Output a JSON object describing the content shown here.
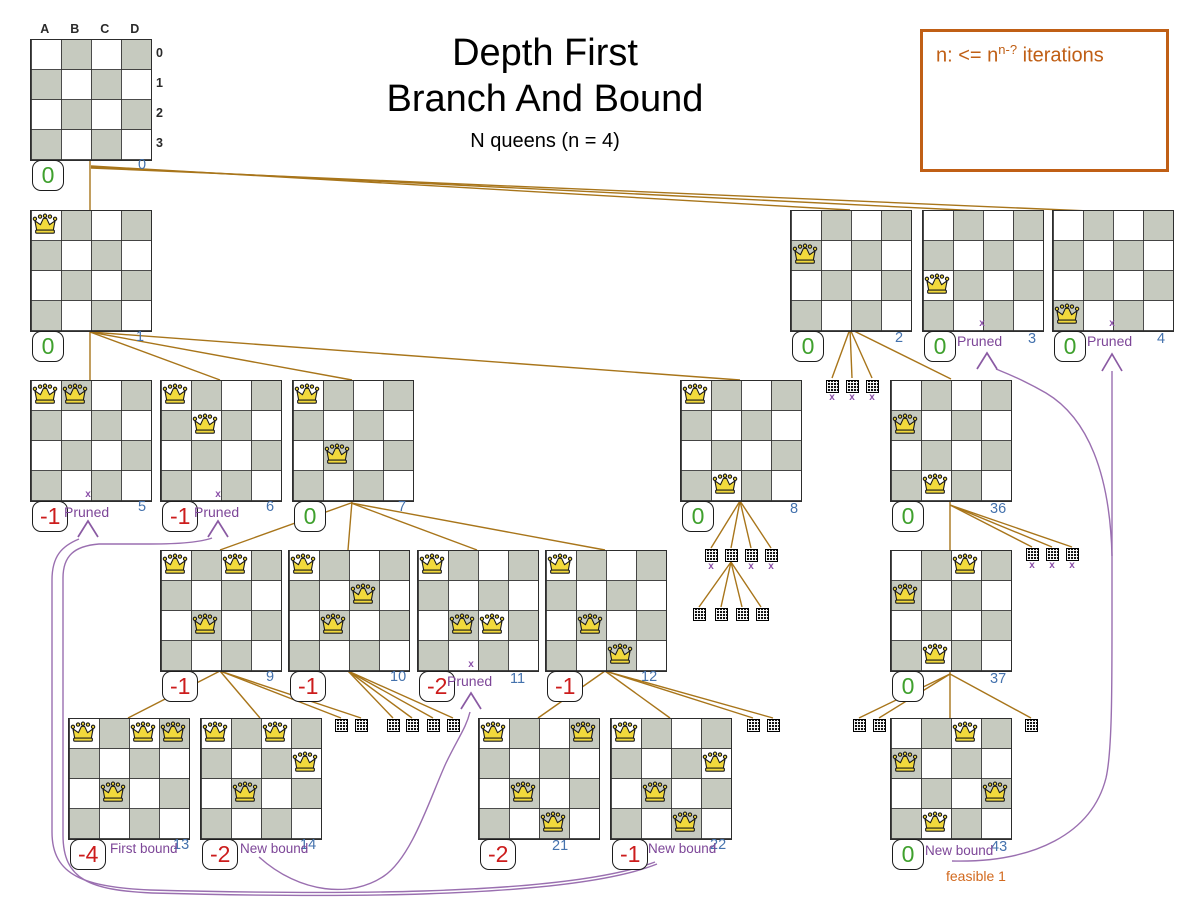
{
  "title": {
    "line1": "Depth First",
    "line2": "Branch And Bound",
    "subtitle": "N queens (n = 4)"
  },
  "legend": {
    "prefix": "n: <= n",
    "sup": "n-?",
    "suffix": " iterations"
  },
  "axis": {
    "cols": [
      "A",
      "B",
      "C",
      "D"
    ],
    "rows": [
      "0",
      "1",
      "2",
      "3"
    ]
  },
  "labels": {
    "pruned": "Pruned",
    "first_bound": "First bound",
    "new_bound": "New bound",
    "feasible": "feasible 1"
  },
  "colors": {
    "tree_line": "#a8751a",
    "prune_curve": "#9a6fb0",
    "prune_arrow": "#8a5aa3",
    "score_good": "#3fa02d",
    "score_bad": "#cc1c1c",
    "node_number": "#4472ad",
    "pruned_text": "#7d4698",
    "feasible_text": "#d2691e",
    "legend_orange": "#c05f15",
    "board_gray": "#c6cabf",
    "queen_gold": "#f2d93c"
  },
  "boards": [
    {
      "id": "0",
      "x": 30,
      "y": 39,
      "queens": [],
      "score": "0",
      "score_type": "good",
      "num": "0",
      "num_x": 138,
      "num_y": 157,
      "axis": true
    },
    {
      "id": "1",
      "x": 30,
      "y": 210,
      "queens": [
        [
          0,
          0
        ]
      ],
      "score": "0",
      "score_type": "good",
      "num": "1",
      "num_x": 136,
      "num_y": 329
    },
    {
      "id": "2",
      "x": 790,
      "y": 210,
      "queens": [
        [
          0,
          1
        ]
      ],
      "score": "0",
      "score_type": "good",
      "num": "2",
      "num_x": 895,
      "num_y": 330
    },
    {
      "id": "3",
      "x": 922,
      "y": 210,
      "queens": [
        [
          0,
          2
        ]
      ],
      "score": "0",
      "score_type": "good",
      "num": "3",
      "num_x": 1028,
      "num_y": 331,
      "pruned": {
        "x_x": 982,
        "x_y": 318,
        "t_x": 957,
        "t_y": 333
      }
    },
    {
      "id": "4",
      "x": 1052,
      "y": 210,
      "queens": [
        [
          0,
          3
        ]
      ],
      "score": "0",
      "score_type": "good",
      "num": "4",
      "num_x": 1157,
      "num_y": 331,
      "pruned": {
        "x_x": 1112,
        "x_y": 318,
        "t_x": 1087,
        "t_y": 333
      }
    },
    {
      "id": "5",
      "x": 30,
      "y": 380,
      "queens": [
        [
          0,
          0
        ],
        [
          1,
          0
        ]
      ],
      "score": "-1",
      "score_type": "bad",
      "num": "5",
      "num_x": 138,
      "num_y": 499,
      "pruned": {
        "x_x": 88,
        "x_y": 489,
        "t_x": 64,
        "t_y": 504
      }
    },
    {
      "id": "6",
      "x": 160,
      "y": 380,
      "queens": [
        [
          0,
          0
        ],
        [
          1,
          1
        ]
      ],
      "score": "-1",
      "score_type": "bad",
      "num": "6",
      "num_x": 266,
      "num_y": 499,
      "pruned": {
        "x_x": 218,
        "x_y": 489,
        "t_x": 194,
        "t_y": 504
      }
    },
    {
      "id": "7",
      "x": 292,
      "y": 380,
      "queens": [
        [
          0,
          0
        ],
        [
          1,
          2
        ]
      ],
      "score": "0",
      "score_type": "good",
      "num": "7",
      "num_x": 398,
      "num_y": 499
    },
    {
      "id": "8",
      "x": 680,
      "y": 380,
      "queens": [
        [
          0,
          0
        ],
        [
          1,
          3
        ]
      ],
      "score": "0",
      "score_type": "good",
      "num": "8",
      "num_x": 790,
      "num_y": 501
    },
    {
      "id": "36",
      "x": 890,
      "y": 380,
      "queens": [
        [
          0,
          1
        ],
        [
          1,
          3
        ]
      ],
      "score": "0",
      "score_type": "good",
      "num": "36",
      "num_x": 990,
      "num_y": 501
    },
    {
      "id": "9",
      "x": 160,
      "y": 550,
      "queens": [
        [
          0,
          0
        ],
        [
          2,
          0
        ],
        [
          1,
          2
        ]
      ],
      "score": "-1",
      "score_type": "bad",
      "num": "9",
      "num_x": 266,
      "num_y": 669
    },
    {
      "id": "10",
      "x": 288,
      "y": 550,
      "queens": [
        [
          0,
          0
        ],
        [
          2,
          1
        ],
        [
          1,
          2
        ]
      ],
      "score": "-1",
      "score_type": "bad",
      "num": "10",
      "num_x": 390,
      "num_y": 669
    },
    {
      "id": "11",
      "x": 417,
      "y": 550,
      "queens": [
        [
          0,
          0
        ],
        [
          1,
          2
        ],
        [
          2,
          2
        ]
      ],
      "score": "-2",
      "score_type": "bad",
      "num": "11",
      "num_x": 510,
      "num_y": 671,
      "pruned": {
        "x_x": 471,
        "x_y": 659,
        "t_x": 447,
        "t_y": 673
      }
    },
    {
      "id": "12",
      "x": 545,
      "y": 550,
      "queens": [
        [
          0,
          0
        ],
        [
          1,
          2
        ],
        [
          2,
          3
        ]
      ],
      "score": "-1",
      "score_type": "bad",
      "num": "12",
      "num_x": 641,
      "num_y": 669
    },
    {
      "id": "37",
      "x": 890,
      "y": 550,
      "queens": [
        [
          2,
          0
        ],
        [
          0,
          1
        ],
        [
          1,
          3
        ]
      ],
      "score": "0",
      "score_type": "good",
      "num": "37",
      "num_x": 990,
      "num_y": 671
    },
    {
      "id": "13",
      "x": 68,
      "y": 718,
      "queens": [
        [
          0,
          0
        ],
        [
          2,
          0
        ],
        [
          3,
          0
        ],
        [
          1,
          2
        ]
      ],
      "score": "-4",
      "score_type": "bad",
      "num": "13",
      "num_x": 173,
      "num_y": 837,
      "bound": {
        "text_key": "first_bound",
        "t_x": 110,
        "t_y": 841
      }
    },
    {
      "id": "14",
      "x": 200,
      "y": 718,
      "queens": [
        [
          0,
          0
        ],
        [
          2,
          0
        ],
        [
          3,
          1
        ],
        [
          1,
          2
        ]
      ],
      "score": "-2",
      "score_type": "bad",
      "num": "14",
      "num_x": 300,
      "num_y": 837,
      "bound": {
        "text_key": "new_bound",
        "t_x": 240,
        "t_y": 841
      }
    },
    {
      "id": "21",
      "x": 478,
      "y": 718,
      "queens": [
        [
          0,
          0
        ],
        [
          3,
          0
        ],
        [
          1,
          2
        ],
        [
          2,
          3
        ]
      ],
      "score": "-2",
      "score_type": "bad",
      "num": "21",
      "num_x": 552,
      "num_y": 838
    },
    {
      "id": "22",
      "x": 610,
      "y": 718,
      "queens": [
        [
          0,
          0
        ],
        [
          3,
          1
        ],
        [
          1,
          2
        ],
        [
          2,
          3
        ]
      ],
      "score": "-1",
      "score_type": "bad",
      "num": "22",
      "num_x": 710,
      "num_y": 837,
      "bound": {
        "text_key": "new_bound",
        "t_x": 648,
        "t_y": 841
      }
    },
    {
      "id": "43",
      "x": 890,
      "y": 718,
      "queens": [
        [
          2,
          0
        ],
        [
          0,
          1
        ],
        [
          3,
          2
        ],
        [
          1,
          3
        ]
      ],
      "score": "0",
      "score_type": "good",
      "num": "43",
      "num_x": 991,
      "num_y": 839,
      "bound": {
        "text_key": "new_bound",
        "t_x": 925,
        "t_y": 843
      },
      "feasible": {
        "t_x": 946,
        "t_y": 868
      }
    }
  ],
  "minis": [
    {
      "x": 826,
      "y": 380,
      "pruned": true
    },
    {
      "x": 846,
      "y": 380,
      "pruned": true
    },
    {
      "x": 866,
      "y": 380,
      "pruned": true
    },
    {
      "x": 705,
      "y": 549,
      "pruned": true
    },
    {
      "x": 725,
      "y": 549,
      "pruned": false
    },
    {
      "x": 745,
      "y": 549,
      "pruned": true
    },
    {
      "x": 765,
      "y": 549,
      "pruned": true
    },
    {
      "x": 693,
      "y": 608,
      "pruned": false
    },
    {
      "x": 715,
      "y": 608,
      "pruned": false
    },
    {
      "x": 736,
      "y": 608,
      "pruned": false
    },
    {
      "x": 756,
      "y": 608,
      "pruned": false
    },
    {
      "x": 1026,
      "y": 548,
      "pruned": true
    },
    {
      "x": 1046,
      "y": 548,
      "pruned": true
    },
    {
      "x": 1066,
      "y": 548,
      "pruned": true
    },
    {
      "x": 335,
      "y": 719,
      "pruned": false
    },
    {
      "x": 355,
      "y": 719,
      "pruned": false
    },
    {
      "x": 387,
      "y": 719,
      "pruned": false
    },
    {
      "x": 406,
      "y": 719,
      "pruned": false
    },
    {
      "x": 427,
      "y": 719,
      "pruned": false
    },
    {
      "x": 447,
      "y": 719,
      "pruned": false
    },
    {
      "x": 747,
      "y": 719,
      "pruned": false
    },
    {
      "x": 767,
      "y": 719,
      "pruned": false
    },
    {
      "x": 853,
      "y": 719,
      "pruned": false
    },
    {
      "x": 873,
      "y": 719,
      "pruned": false
    },
    {
      "x": 1025,
      "y": 719,
      "pruned": false
    }
  ]
}
